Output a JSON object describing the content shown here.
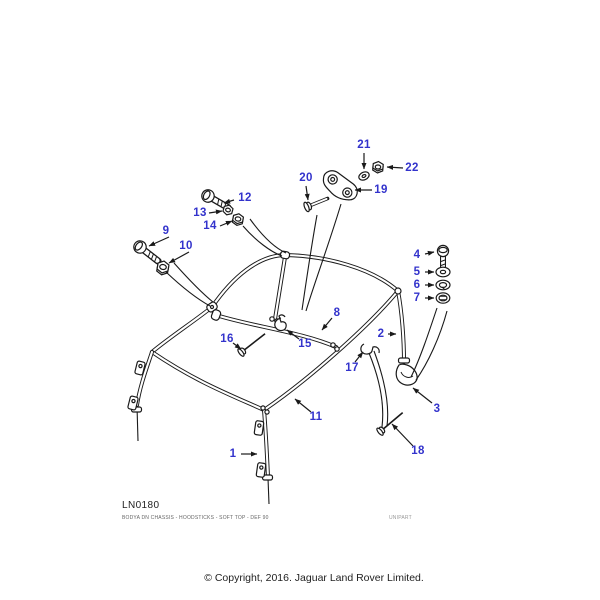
{
  "diagram": {
    "drawing_code": "LN0180",
    "description": "BODYA DN CHASSIS - HOODSTICKS - SOFT TOP - DEF 90",
    "brand": "UNIPART",
    "copyright": "© Copyright, 2016. Jaguar Land Rover Limited.",
    "callout_color": "#3333cc",
    "line_color": "#1a1a1a",
    "background_color": "#ffffff"
  },
  "callouts": [
    {
      "label": "1"
    },
    {
      "label": "2"
    },
    {
      "label": "3"
    },
    {
      "label": "4"
    },
    {
      "label": "5"
    },
    {
      "label": "6"
    },
    {
      "label": "7"
    },
    {
      "label": "8"
    },
    {
      "label": "9"
    },
    {
      "label": "10"
    },
    {
      "label": "11"
    },
    {
      "label": "12"
    },
    {
      "label": "13"
    },
    {
      "label": "14"
    },
    {
      "label": "15"
    },
    {
      "label": "16"
    },
    {
      "label": "17"
    },
    {
      "label": "18"
    },
    {
      "label": "19"
    },
    {
      "label": "20"
    },
    {
      "label": "21"
    },
    {
      "label": "22"
    }
  ]
}
